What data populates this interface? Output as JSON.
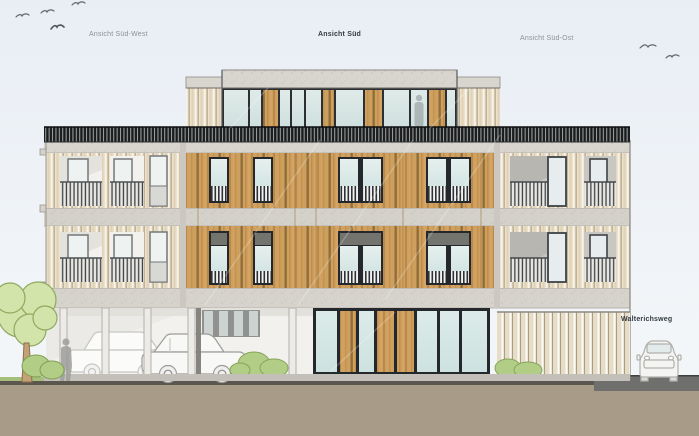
{
  "labels": {
    "elevation_left": "Ansicht Süd-West",
    "elevation_center": "Ansicht Süd",
    "elevation_right": "Ansicht Süd-Ost",
    "street_name": "Walterichsweg"
  },
  "colors": {
    "sky": "#e9eef5",
    "wood_facade": "#cf9f5f",
    "pale_wood": "#ebe1cd",
    "concrete": "#d8d5ce",
    "glass": "#dbe9e7",
    "window_frame": "#24282c",
    "railing_band": "#1a1d20",
    "transom_gray": "#74746f",
    "ground": "#a89b88",
    "street": "#6f6f6e",
    "foliage": "#d3e4ab",
    "label_muted": "#8a9199",
    "label_dark": "#333b41"
  }
}
